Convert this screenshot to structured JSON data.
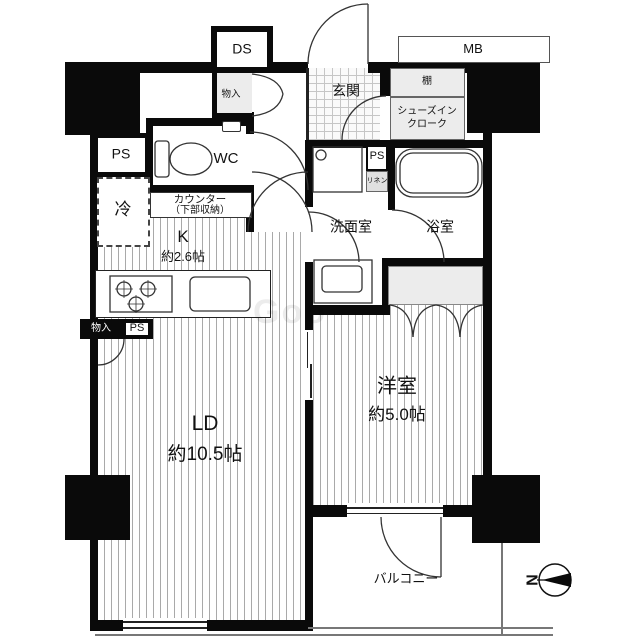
{
  "texts": {
    "ds": "DS",
    "mb": "MB",
    "shelf": "棚",
    "shoes_closet_line1": "シューズイン",
    "shoes_closet_line2": "クローク",
    "entrance": "玄関",
    "storage": "物入",
    "ps": "PS",
    "wc": "WC",
    "counter_line1": "カウンター",
    "counter_line2": "（下部収納）",
    "refrigerator": "冷",
    "kitchen": "K",
    "kitchen_area": "約2.6帖",
    "washroom": "洗面室",
    "linen": "リネン",
    "bathroom": "浴室",
    "living_dining": "LD",
    "living_dining_area": "約10.5帖",
    "western_room": "洋室",
    "western_room_area": "約5.0帖",
    "balcony": "バルコニー",
    "compass_north": "N",
    "watermark": "Goo"
  },
  "colors": {
    "wall": "#0a0a0a",
    "floor_stripe": "#a9a9a9",
    "closet_fill": "#ececec",
    "tile_line": "#c6c6c6"
  }
}
